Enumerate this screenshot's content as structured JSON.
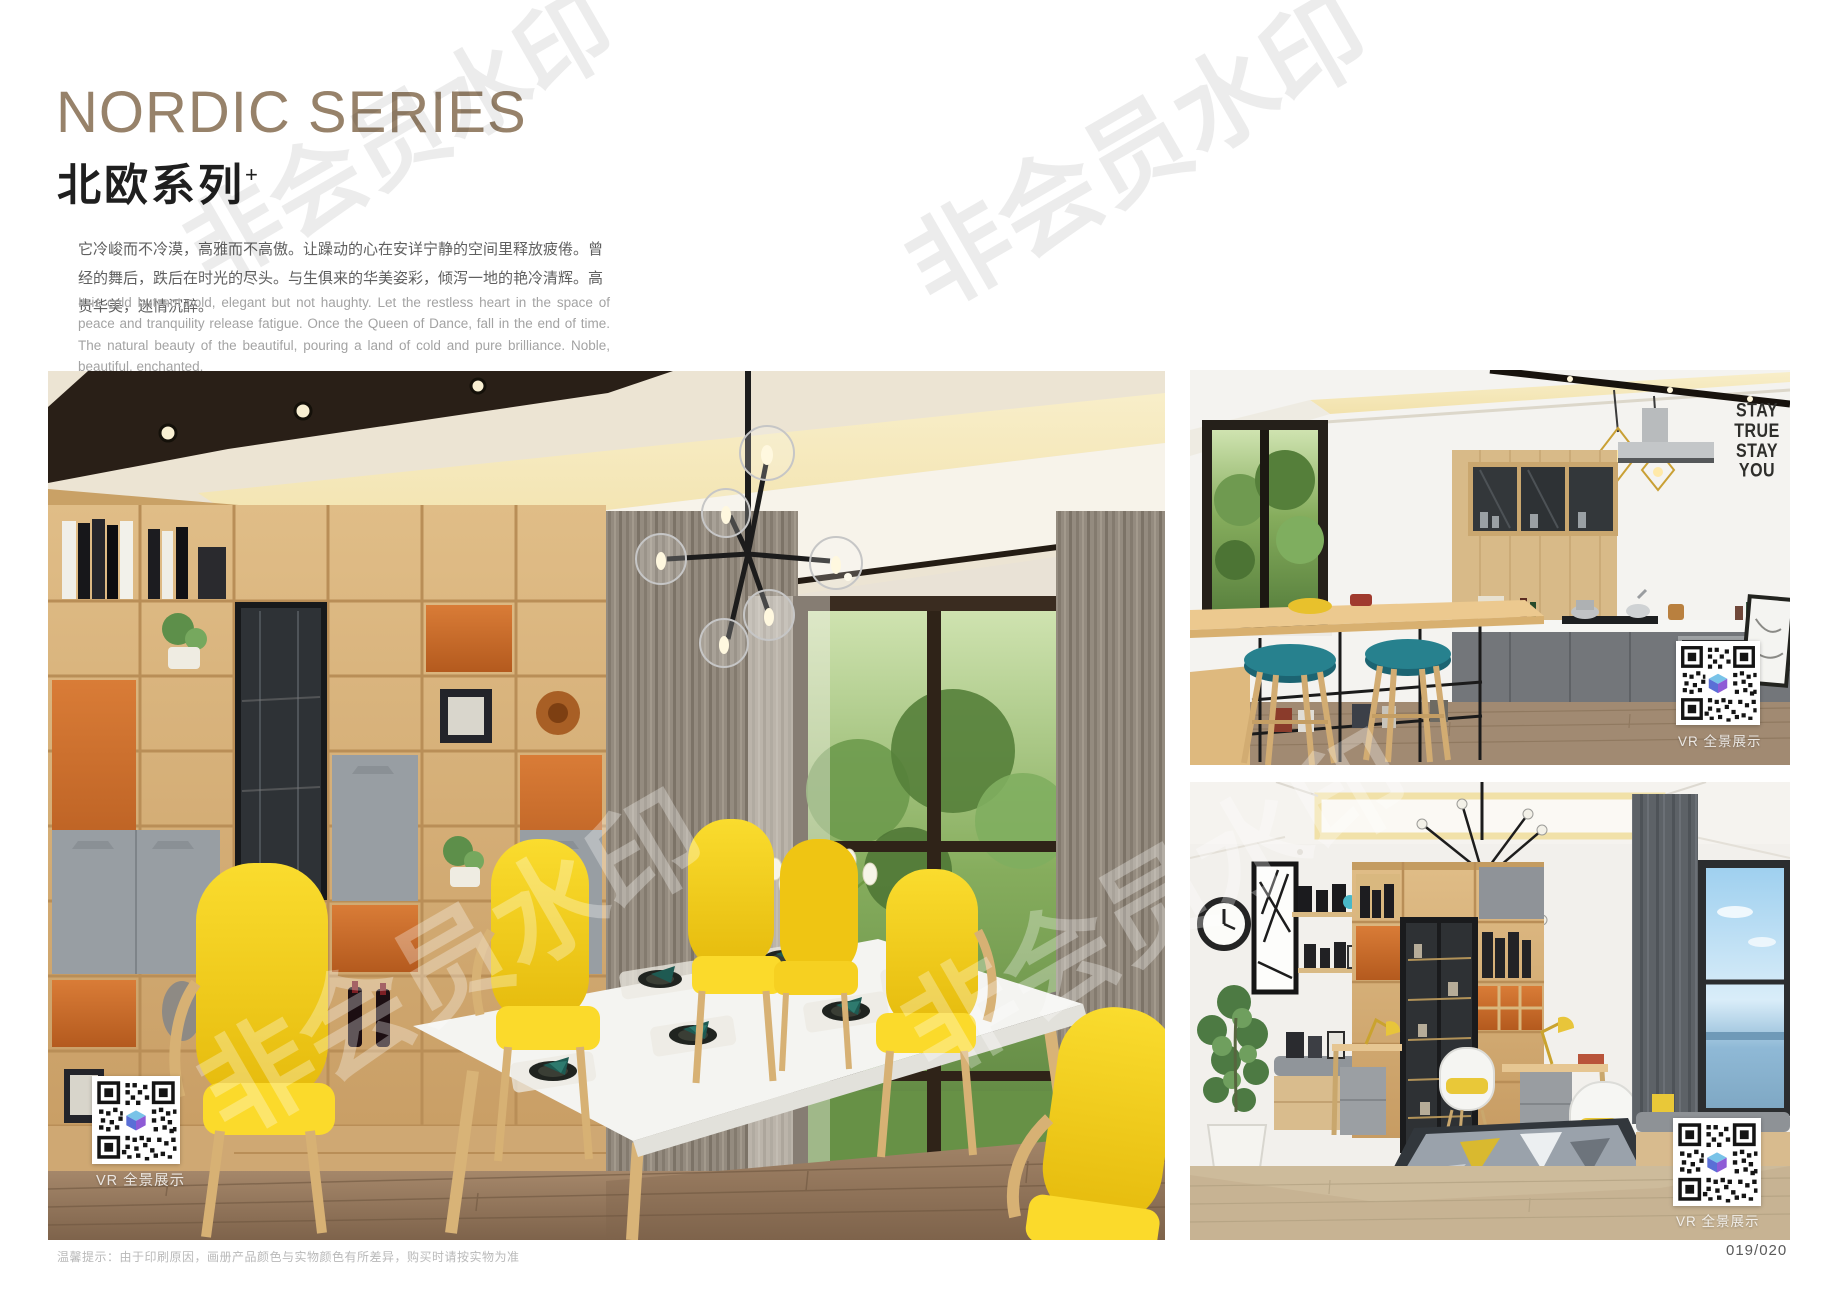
{
  "header": {
    "title_en": "NORDIC SERIES",
    "title_cn": "北欧系列",
    "title_sup": "+",
    "intro_cn": "它冷峻而不冷漠，高雅而不高傲。让躁动的心在安详宁静的空间里释放疲倦。曾经的舞后，跌后在时光的尽头。与生俱来的华美姿彩，倾泻一地的艳冷清辉。高贵华美，迷情沉醉。",
    "intro_en": "It is cold but not cold, elegant but not haughty. Let the restless heart in the space of peace and tranquility release fatigue. Once the Queen of Dance, fall in the end of time. The natural beauty of the beautiful, pouring a land of cold and pure brilliance. Noble, beautiful, enchanted."
  },
  "watermark": {
    "text": "非会员水印"
  },
  "photos": {
    "dining": {
      "vr_label": "VR 全景展示"
    },
    "kitchen": {
      "vr_label": "VR 全景展示",
      "decal": [
        "STAY",
        "TRUE",
        "STAY",
        "YOU"
      ]
    },
    "study": {
      "vr_label": "VR 全景展示"
    }
  },
  "footer": {
    "note": "温馨提示：由于印刷原因，画册产品颜色与实物颜色有所差异，购买时请按实物为准",
    "page_number": "019/020"
  },
  "colors": {
    "title_bronze": "#97826a",
    "accent_orange": "#cd6c2e",
    "chair_yellow": "#f6d31c",
    "stool_teal": "#27818e",
    "wood_light": "#d9b57e"
  }
}
